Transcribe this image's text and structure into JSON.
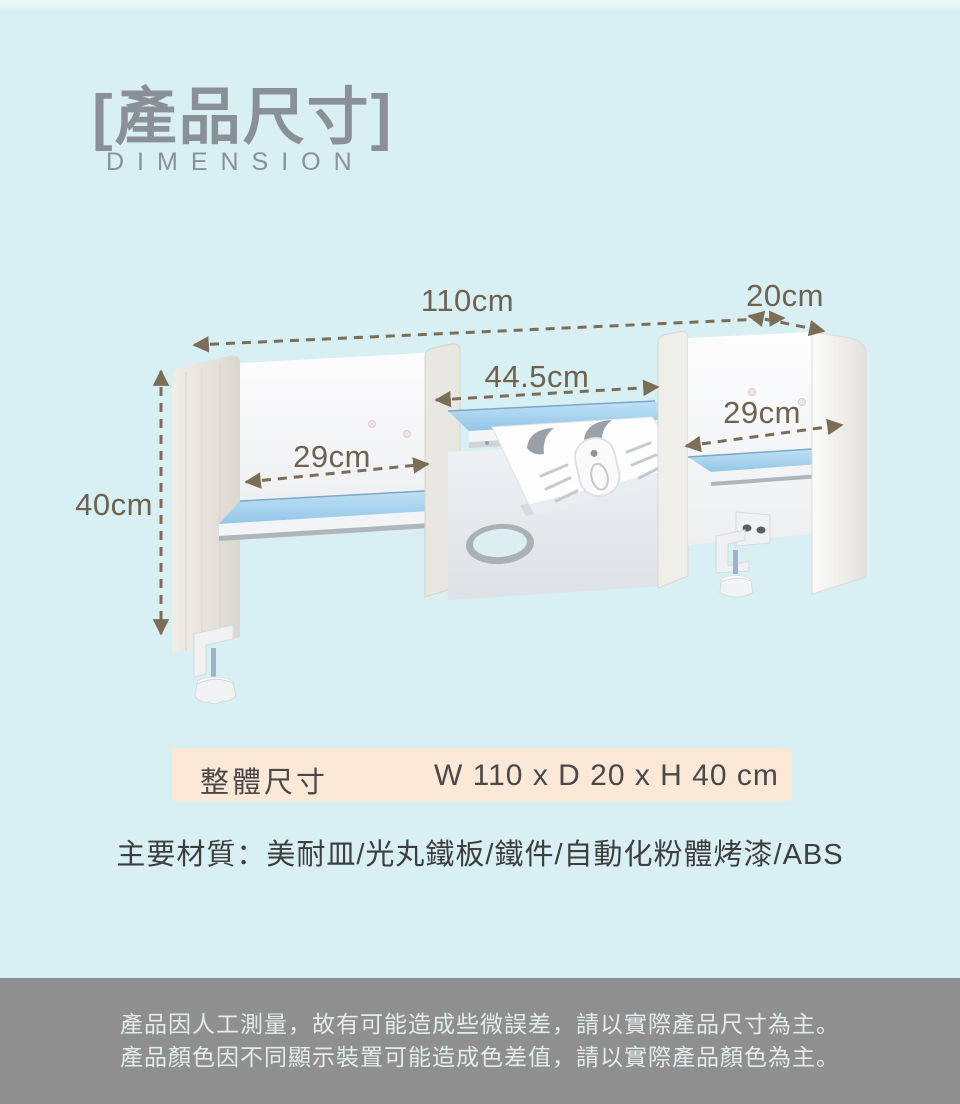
{
  "header": {
    "title": "[產品尺寸]",
    "subtitle": "DIMENSION"
  },
  "diagram": {
    "dim_width_total": "110cm",
    "dim_depth": "20cm",
    "dim_center_shelf": "44.5cm",
    "dim_right_bay": "29cm",
    "dim_left_bay": "29cm",
    "dim_height": "40cm",
    "values": {
      "width_cm": 110,
      "depth_cm": 20,
      "height_cm": 40,
      "center_shelf_cm": 44.5,
      "side_bay_cm": 29
    }
  },
  "spec": {
    "size_label": "整體尺寸",
    "size_value": "W 110 x D 20 x H 40 cm",
    "materials": "主要材質：美耐皿/光丸鐵板/鐵件/自動化粉體烤漆/ABS"
  },
  "footer": {
    "line1": "產品因人工測量，故有可能造成些微誤差，請以實際產品尺寸為主。",
    "line2": "產品顏色因不同顯示裝置可能造成色差值，請以實際產品顏色為主。"
  },
  "colors": {
    "background": "#d8eff3",
    "title_gray": "#899097",
    "dimension_text": "#6e6250",
    "arrow_brown": "#7c6d57",
    "spec_bar_bg": "#fbe8d6",
    "shelf_blue": "#a5d1ee",
    "footer_bg": "#8f8f8f",
    "footer_text": "#e2ecec"
  }
}
